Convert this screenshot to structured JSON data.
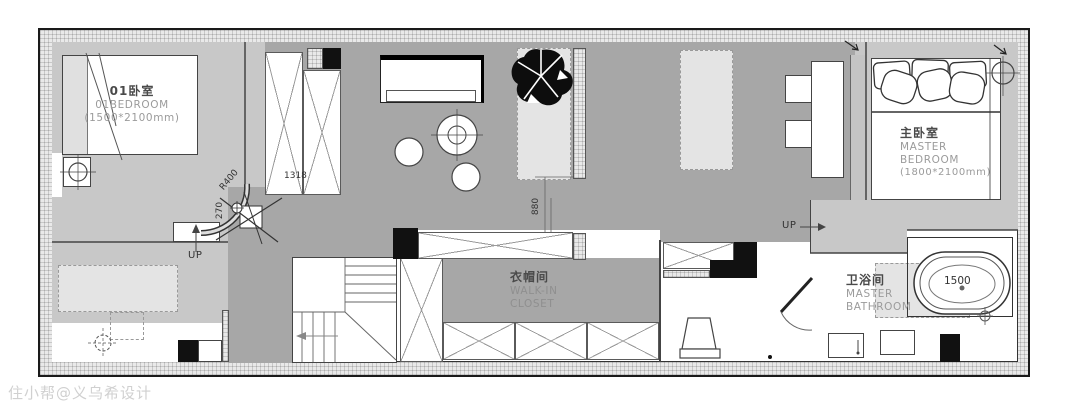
{
  "plan": {
    "rooms": {
      "bedroom01": {
        "name_cn": "01卧室",
        "name_en": "01BEDROOM",
        "size": "(1500*2100mm)"
      },
      "master_bedroom": {
        "name_cn": "主卧室",
        "name_en_line1": "MASTER",
        "name_en_line2": "BEDROOM",
        "size": "(1800*2100mm)"
      },
      "walk_in_closet": {
        "name_cn": "衣帽间",
        "name_en_line1": "WALK-IN",
        "name_en_line2": "CLOSET"
      },
      "master_bathroom": {
        "name_cn": "卫浴间",
        "name_en_line1": "MASTER",
        "name_en_line2": "BATHROOM"
      }
    },
    "dimensions": {
      "wardrobe_width": "1318",
      "corner_radius": "R400",
      "corner_offset": "270",
      "door_opening": "880",
      "bathtub_length": "1500"
    },
    "stairs": {
      "up_left": "UP",
      "up_right": "UP"
    },
    "colors": {
      "floor_dark": "#a7a7a7",
      "floor_light": "#c8c8c8",
      "furniture_light": "#e4e4e4",
      "wall": "#2b2b2b"
    },
    "watermark": "住小帮@义乌希设计"
  }
}
